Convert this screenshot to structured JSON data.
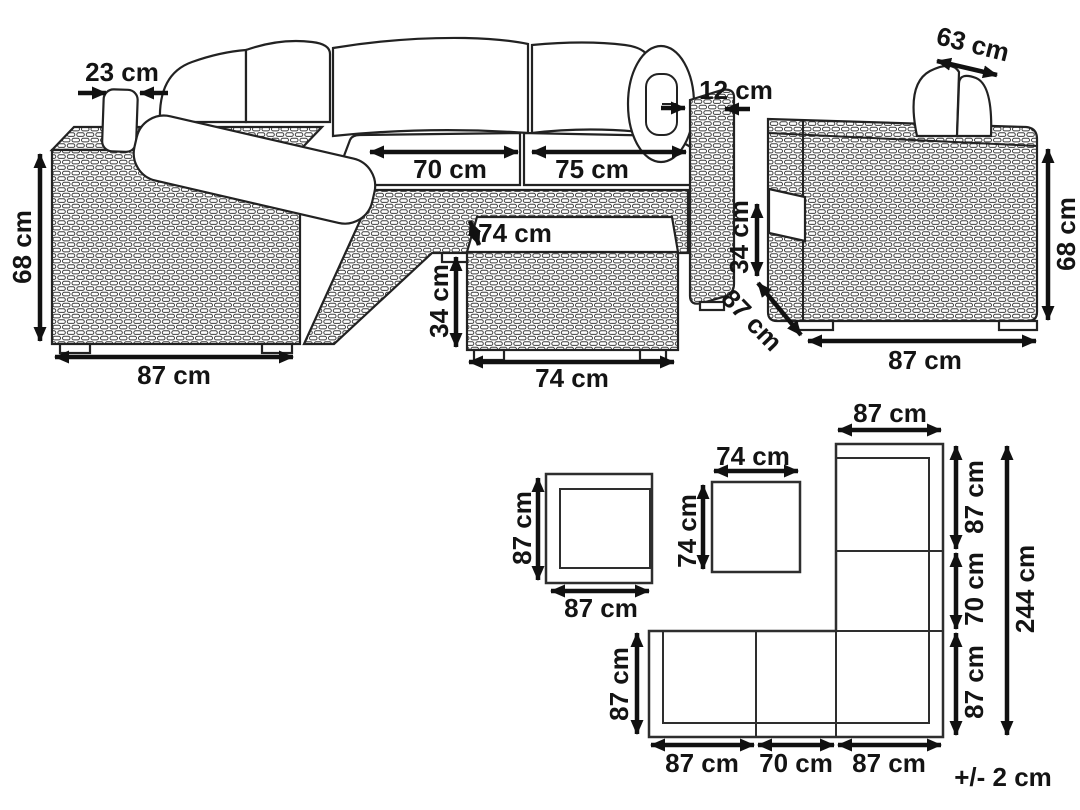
{
  "diagram": {
    "unit": "cm",
    "tolerance": "+/- 2 cm",
    "sofa": {
      "pillow_thickness": "23 cm",
      "height": "68 cm",
      "armrest_width": "87 cm",
      "seat_left": "70 cm",
      "seat_right": "75 cm",
      "armrest_thickness": "12 cm"
    },
    "table": {
      "depth": "74 cm",
      "height": "34 cm",
      "width": "74 cm"
    },
    "armchair": {
      "headrest_width": "63 cm",
      "armrest_height": "34 cm",
      "depth": "87 cm",
      "height": "68 cm",
      "width": "87 cm"
    },
    "plan_armchair": {
      "depth": "87 cm",
      "width": "87 cm"
    },
    "plan_table": {
      "width": "74 cm",
      "depth": "74 cm"
    },
    "plan_sofa": {
      "top_width": "87 cm",
      "right_upper": "87 cm",
      "right_middle": "70 cm",
      "right_lower": "87 cm",
      "total_length": "244 cm",
      "bottom_left": "87 cm",
      "bottom_middle": "70 cm",
      "bottom_right": "87 cm",
      "left_depth": "87 cm"
    }
  }
}
